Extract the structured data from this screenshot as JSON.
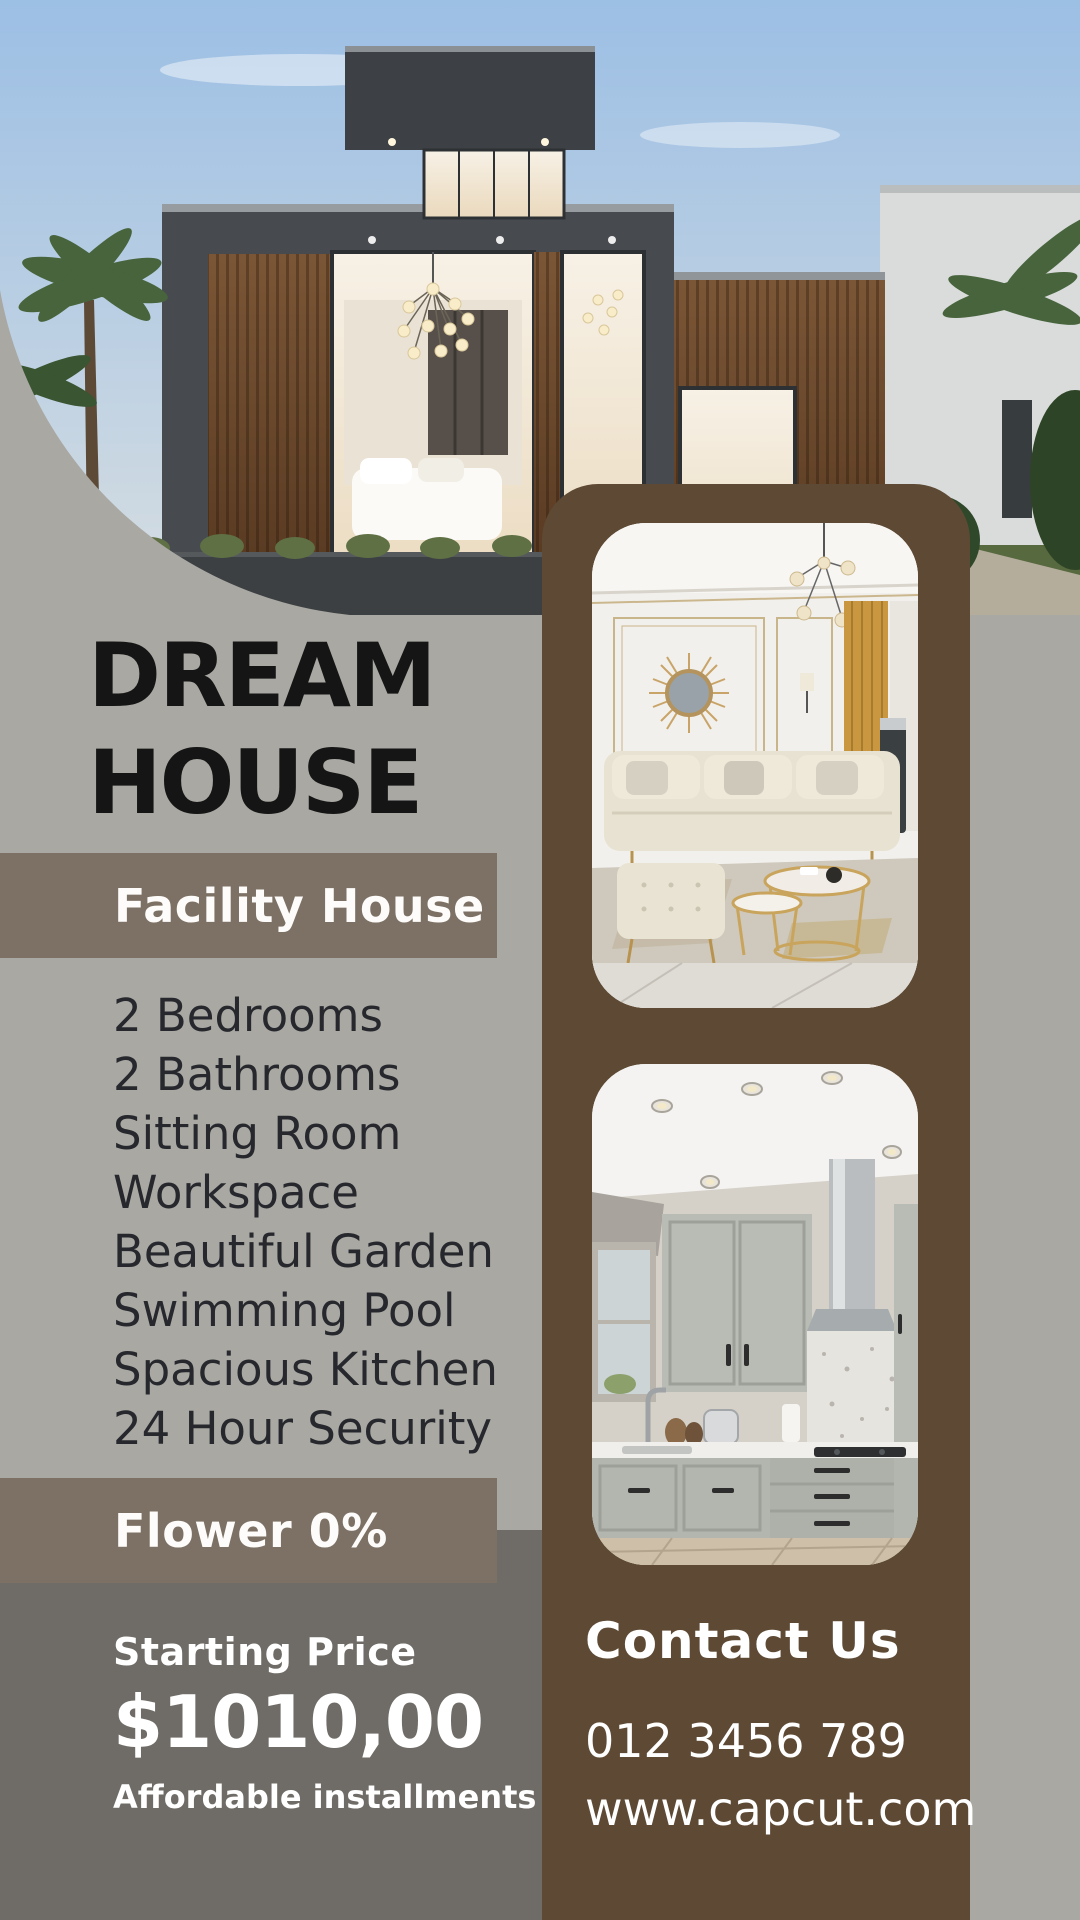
{
  "title": {
    "line1": "DREAM",
    "line2": "HOUSE"
  },
  "facility": {
    "header": "Facility House",
    "items": [
      "2 Bedrooms",
      "2 Bathrooms",
      "Sitting Room",
      "Workspace",
      "Beautiful Garden",
      "Swimming Pool",
      "Spacious Kitchen",
      "24 Hour Security"
    ]
  },
  "flower": {
    "label": "Flower 0%"
  },
  "pricing": {
    "heading": "Starting Price",
    "price": "$1010,00",
    "note": "Affordable installments"
  },
  "contact": {
    "heading": "Contact Us",
    "phone": "012 3456 789",
    "website": "www.capcut.com"
  },
  "images": {
    "hero": "modern-two-story-house-exterior",
    "card1": "living-room-interior",
    "card2": "kitchen-interior"
  },
  "colors": {
    "background_gray": "#a9a8a3",
    "bar_brown_gray": "#7c7164",
    "dark_gray_section": "#6f6b66",
    "panel_brown": "#5e4a34",
    "title_text": "#151515",
    "list_text": "#26282d",
    "white_text": "#ffffff"
  }
}
